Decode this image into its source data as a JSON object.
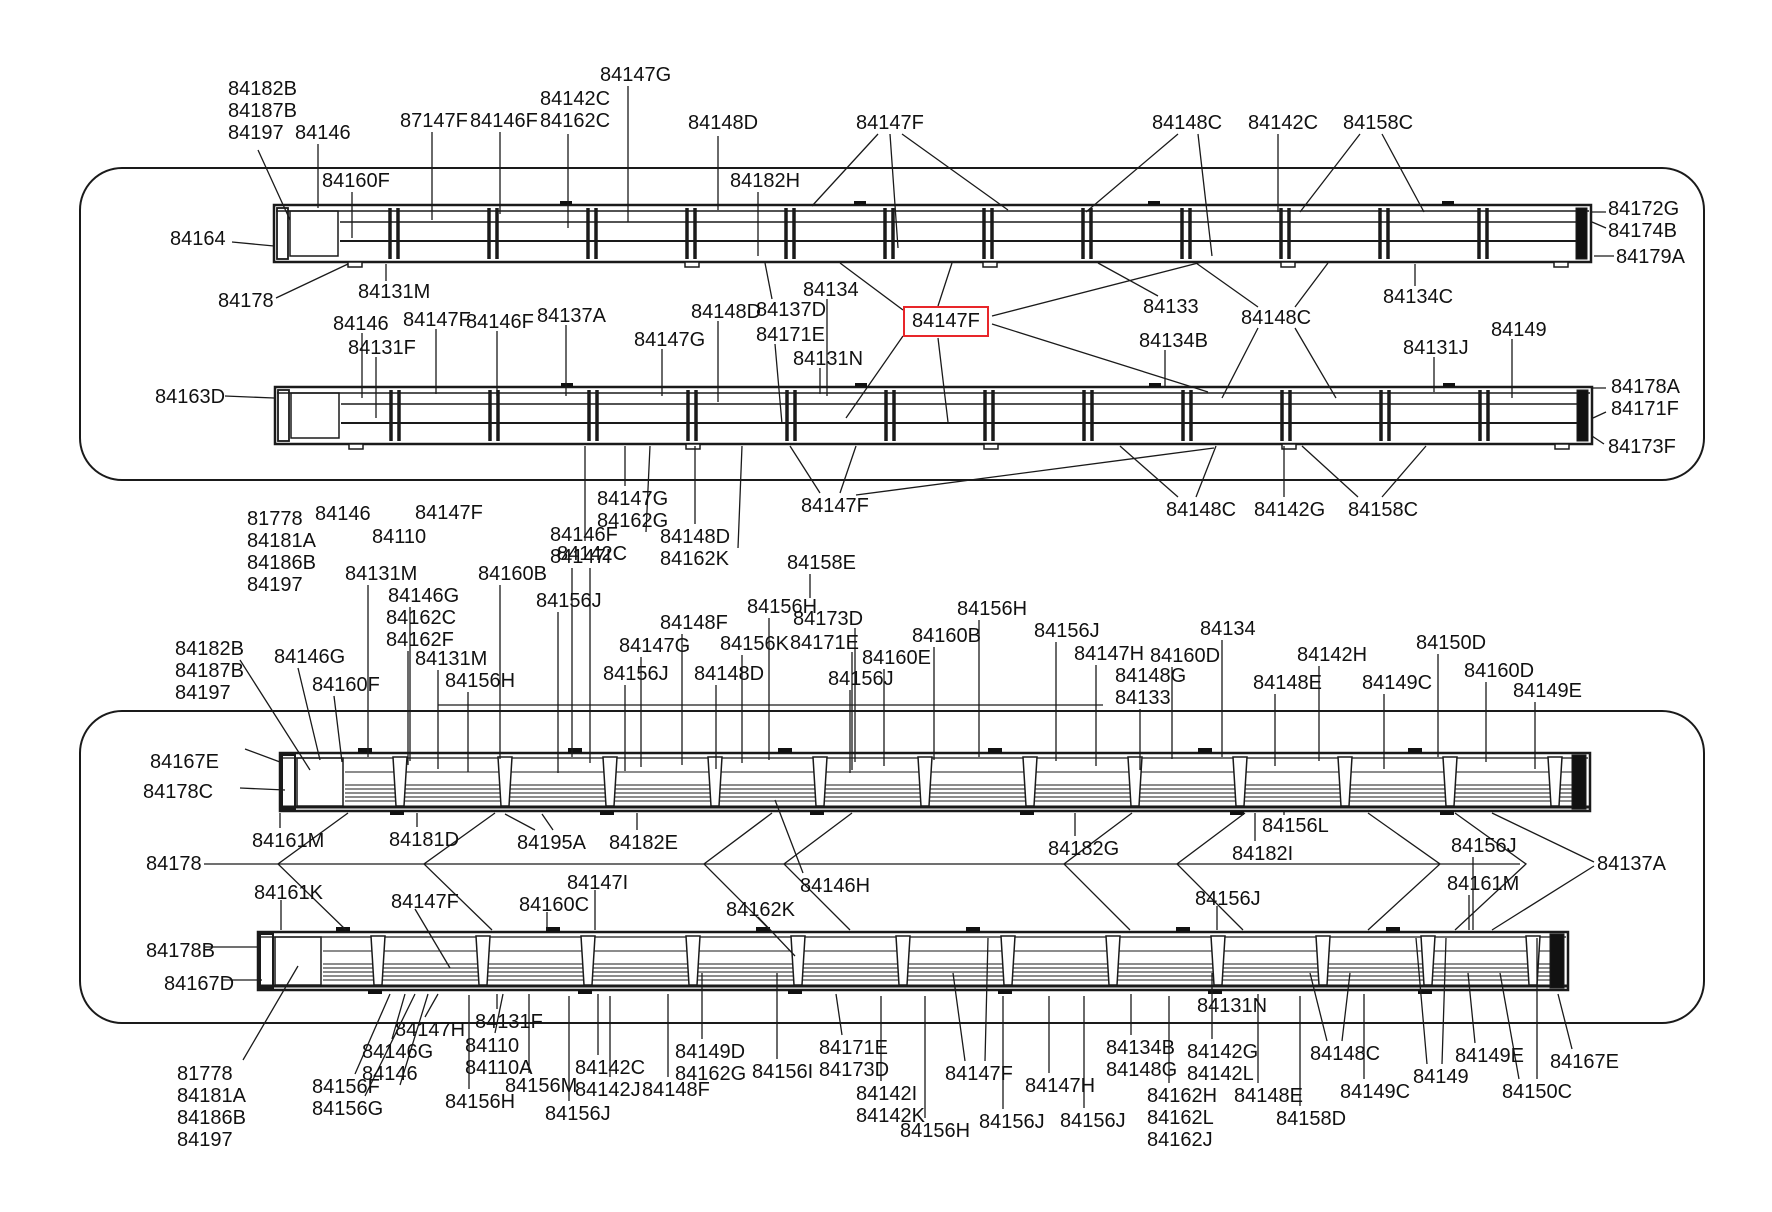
{
  "diagram": {
    "description": "Vehicle side-rail parts diagram with callout part numbers",
    "highlighted_part": "84147F",
    "colors": {
      "line": "#1a1a1a",
      "highlight_box": "#e8262a",
      "background": "#ffffff",
      "text": "#111111"
    },
    "labels": [
      {
        "t": "84147G",
        "x": 600,
        "y": 64
      },
      {
        "t": "84142C\n84162C",
        "x": 540,
        "y": 88
      },
      {
        "t": "87147F",
        "x": 400,
        "y": 110
      },
      {
        "t": "84146F",
        "x": 470,
        "y": 110
      },
      {
        "t": "84148D",
        "x": 688,
        "y": 112
      },
      {
        "t": "84182B\n84187B\n84197",
        "x": 228,
        "y": 78
      },
      {
        "t": "84146",
        "x": 295,
        "y": 122
      },
      {
        "t": "84147F",
        "x": 856,
        "y": 112
      },
      {
        "t": "84148C",
        "x": 1152,
        "y": 112
      },
      {
        "t": "84142C",
        "x": 1248,
        "y": 112
      },
      {
        "t": "84158C",
        "x": 1343,
        "y": 112
      },
      {
        "t": "84182H",
        "x": 730,
        "y": 170
      },
      {
        "t": "84160F",
        "x": 322,
        "y": 170
      },
      {
        "t": "84164",
        "x": 170,
        "y": 228
      },
      {
        "t": "84172G\n84174B",
        "x": 1608,
        "y": 198
      },
      {
        "t": "84179A",
        "x": 1616,
        "y": 246
      },
      {
        "t": "84134C",
        "x": 1383,
        "y": 286
      },
      {
        "t": "84178",
        "x": 218,
        "y": 290
      },
      {
        "t": "84131M",
        "x": 358,
        "y": 281
      },
      {
        "t": "84146",
        "x": 333,
        "y": 313
      },
      {
        "t": "84147F",
        "x": 403,
        "y": 309
      },
      {
        "t": "84146F",
        "x": 466,
        "y": 311
      },
      {
        "t": "84137A",
        "x": 537,
        "y": 305
      },
      {
        "t": "84131F",
        "x": 348,
        "y": 337
      },
      {
        "t": "84147G",
        "x": 634,
        "y": 329
      },
      {
        "t": "84148D",
        "x": 691,
        "y": 301
      },
      {
        "t": "84137D",
        "x": 756,
        "y": 299
      },
      {
        "t": "84171E",
        "x": 756,
        "y": 324
      },
      {
        "t": "84134",
        "x": 803,
        "y": 279
      },
      {
        "t": "84131N",
        "x": 793,
        "y": 348
      },
      {
        "t": "84147F",
        "x": 912,
        "y": 314,
        "boxed": true
      },
      {
        "t": "84133",
        "x": 1143,
        "y": 296
      },
      {
        "t": "84134B",
        "x": 1139,
        "y": 330
      },
      {
        "t": "84148C",
        "x": 1241,
        "y": 307
      },
      {
        "t": "84131J",
        "x": 1403,
        "y": 337
      },
      {
        "t": "84149",
        "x": 1491,
        "y": 319
      },
      {
        "t": "84178A\n84171F",
        "x": 1611,
        "y": 376
      },
      {
        "t": "84173F",
        "x": 1608,
        "y": 436
      },
      {
        "t": "84163D",
        "x": 155,
        "y": 386
      },
      {
        "t": "84147G\n84162G",
        "x": 597,
        "y": 488
      },
      {
        "t": "84142C",
        "x": 557,
        "y": 543
      },
      {
        "t": "84148D\n84162K",
        "x": 660,
        "y": 526
      },
      {
        "t": "84158E",
        "x": 787,
        "y": 552
      },
      {
        "t": "84147F",
        "x": 801,
        "y": 495
      },
      {
        "t": "84148C",
        "x": 1166,
        "y": 499
      },
      {
        "t": "84142G",
        "x": 1254,
        "y": 499
      },
      {
        "t": "84158C",
        "x": 1348,
        "y": 499
      },
      {
        "t": "81778\n84181A\n84186B\n84197",
        "x": 247,
        "y": 508
      },
      {
        "t": "84146",
        "x": 315,
        "y": 503
      },
      {
        "t": "84110",
        "x": 372,
        "y": 526
      },
      {
        "t": "84147F",
        "x": 415,
        "y": 502
      },
      {
        "t": "84131M",
        "x": 345,
        "y": 563
      },
      {
        "t": "84146G",
        "x": 388,
        "y": 585
      },
      {
        "t": "84162C\n84162F",
        "x": 386,
        "y": 607
      },
      {
        "t": "84131M",
        "x": 415,
        "y": 648
      },
      {
        "t": "84156H",
        "x": 445,
        "y": 670
      },
      {
        "t": "84160B",
        "x": 478,
        "y": 563
      },
      {
        "t": "84156J",
        "x": 536,
        "y": 590
      },
      {
        "t": "84146F\n84147I",
        "x": 550,
        "y": 524
      },
      {
        "t": "84148F",
        "x": 660,
        "y": 612
      },
      {
        "t": "84147G",
        "x": 619,
        "y": 635
      },
      {
        "t": "84156K",
        "x": 720,
        "y": 633
      },
      {
        "t": "84156J",
        "x": 603,
        "y": 663
      },
      {
        "t": "84148D",
        "x": 694,
        "y": 663
      },
      {
        "t": "84156H",
        "x": 747,
        "y": 596
      },
      {
        "t": "84173D",
        "x": 793,
        "y": 608
      },
      {
        "t": "84171E",
        "x": 790,
        "y": 632
      },
      {
        "t": "84156J",
        "x": 828,
        "y": 668
      },
      {
        "t": "84160E",
        "x": 862,
        "y": 647
      },
      {
        "t": "84160B",
        "x": 912,
        "y": 625
      },
      {
        "t": "84156H",
        "x": 957,
        "y": 598
      },
      {
        "t": "84156J",
        "x": 1034,
        "y": 620
      },
      {
        "t": "84147H",
        "x": 1074,
        "y": 643
      },
      {
        "t": "84160D",
        "x": 1150,
        "y": 645
      },
      {
        "t": "84148G\n84133",
        "x": 1115,
        "y": 665
      },
      {
        "t": "84134",
        "x": 1200,
        "y": 618
      },
      {
        "t": "84142H",
        "x": 1297,
        "y": 644
      },
      {
        "t": "84148E",
        "x": 1253,
        "y": 672
      },
      {
        "t": "84149C",
        "x": 1362,
        "y": 672
      },
      {
        "t": "84150D",
        "x": 1416,
        "y": 632
      },
      {
        "t": "84160D",
        "x": 1464,
        "y": 660
      },
      {
        "t": "84149E",
        "x": 1513,
        "y": 680
      },
      {
        "t": "84182B\n84187B\n84197",
        "x": 175,
        "y": 638
      },
      {
        "t": "84146G",
        "x": 274,
        "y": 646
      },
      {
        "t": "84160F",
        "x": 312,
        "y": 674
      },
      {
        "t": "84167E",
        "x": 150,
        "y": 751
      },
      {
        "t": "84178C",
        "x": 143,
        "y": 781
      },
      {
        "t": "84161M",
        "x": 252,
        "y": 830
      },
      {
        "t": "84181D",
        "x": 389,
        "y": 829
      },
      {
        "t": "84195A",
        "x": 517,
        "y": 832
      },
      {
        "t": "84182E",
        "x": 609,
        "y": 832
      },
      {
        "t": "84178",
        "x": 146,
        "y": 853
      },
      {
        "t": "84161K",
        "x": 254,
        "y": 882
      },
      {
        "t": "84147F",
        "x": 391,
        "y": 891
      },
      {
        "t": "84147I",
        "x": 567,
        "y": 872
      },
      {
        "t": "84160C",
        "x": 519,
        "y": 894
      },
      {
        "t": "84146H",
        "x": 800,
        "y": 875
      },
      {
        "t": "84162K",
        "x": 726,
        "y": 899
      },
      {
        "t": "84182G",
        "x": 1048,
        "y": 838
      },
      {
        "t": "84156L",
        "x": 1262,
        "y": 815
      },
      {
        "t": "84182I",
        "x": 1232,
        "y": 843
      },
      {
        "t": "84156J",
        "x": 1451,
        "y": 835
      },
      {
        "t": "84161M",
        "x": 1447,
        "y": 873
      },
      {
        "t": "84156J",
        "x": 1195,
        "y": 888
      },
      {
        "t": "84137A",
        "x": 1597,
        "y": 853
      },
      {
        "t": "84178B",
        "x": 146,
        "y": 940
      },
      {
        "t": "84167D",
        "x": 164,
        "y": 973
      },
      {
        "t": "81778\n84181A\n84186B\n84197",
        "x": 177,
        "y": 1063
      },
      {
        "t": "84156F\n84156G",
        "x": 312,
        "y": 1076
      },
      {
        "t": "84146G\n84146",
        "x": 362,
        "y": 1041
      },
      {
        "t": "84147H",
        "x": 395,
        "y": 1019
      },
      {
        "t": "84131F",
        "x": 475,
        "y": 1011
      },
      {
        "t": "84110\n84110A",
        "x": 465,
        "y": 1035
      },
      {
        "t": "84156M",
        "x": 505,
        "y": 1075
      },
      {
        "t": "84142C",
        "x": 575,
        "y": 1057
      },
      {
        "t": "84142J",
        "x": 575,
        "y": 1079
      },
      {
        "t": "84148F",
        "x": 642,
        "y": 1079
      },
      {
        "t": "84156J",
        "x": 545,
        "y": 1103
      },
      {
        "t": "84156H",
        "x": 445,
        "y": 1091
      },
      {
        "t": "84149D\n84162G",
        "x": 675,
        "y": 1041
      },
      {
        "t": "84156I",
        "x": 752,
        "y": 1061
      },
      {
        "t": "84171E\n84173D",
        "x": 819,
        "y": 1037
      },
      {
        "t": "84142I\n84142K",
        "x": 856,
        "y": 1083
      },
      {
        "t": "84156H",
        "x": 900,
        "y": 1120
      },
      {
        "t": "84156J",
        "x": 979,
        "y": 1111
      },
      {
        "t": "84147F",
        "x": 945,
        "y": 1063
      },
      {
        "t": "84147H",
        "x": 1025,
        "y": 1075
      },
      {
        "t": "84156J",
        "x": 1060,
        "y": 1110
      },
      {
        "t": "84134B\n84148G",
        "x": 1106,
        "y": 1037
      },
      {
        "t": "84162H\n84162L\n84162J",
        "x": 1147,
        "y": 1085
      },
      {
        "t": "84142G\n84142L",
        "x": 1187,
        "y": 1041
      },
      {
        "t": "84148E",
        "x": 1234,
        "y": 1085
      },
      {
        "t": "84158D",
        "x": 1276,
        "y": 1108
      },
      {
        "t": "84148C",
        "x": 1310,
        "y": 1043
      },
      {
        "t": "84149C",
        "x": 1340,
        "y": 1081
      },
      {
        "t": "84149",
        "x": 1413,
        "y": 1066
      },
      {
        "t": "84149E",
        "x": 1455,
        "y": 1045
      },
      {
        "t": "84150C",
        "x": 1502,
        "y": 1081
      },
      {
        "t": "84167E",
        "x": 1550,
        "y": 1051
      },
      {
        "t": "84131N",
        "x": 1197,
        "y": 995
      }
    ]
  }
}
